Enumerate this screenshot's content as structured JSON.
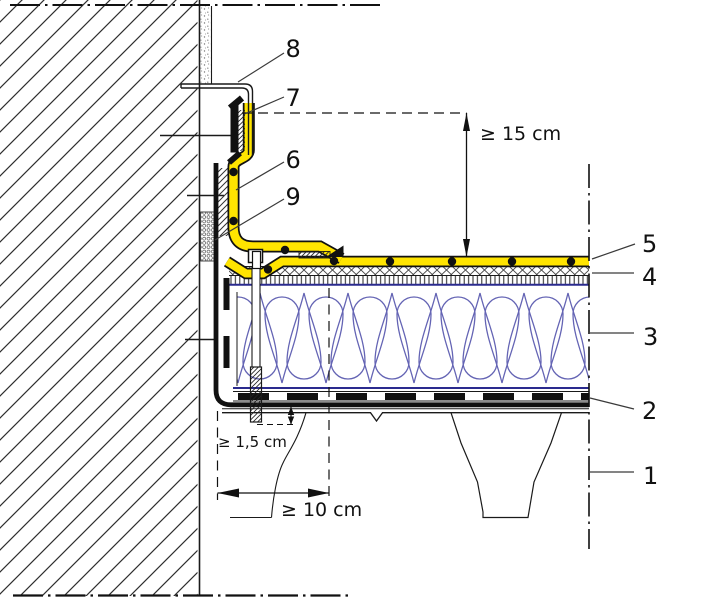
{
  "figure": {
    "type": "construction-detail-section",
    "callouts": {
      "cap_flashing": "8",
      "clamping_rail": "7",
      "membrane_upstand": "6",
      "backing_strip": "9",
      "roof_membrane": "5",
      "separation_layer": "4",
      "insulation": "3",
      "vapour_barrier": "2",
      "deck": "1"
    },
    "dimensions": {
      "upstand_height": "≥ 15 cm",
      "fastener_projection": "≥ 1,5 cm",
      "overlap_width": "≥ 10 cm"
    },
    "colors": {
      "membrane_yellow": "#ffe400",
      "insulation_blue": "#6464b4",
      "navy_line": "#2a2a8e",
      "line_black": "#1a1a1a"
    }
  }
}
